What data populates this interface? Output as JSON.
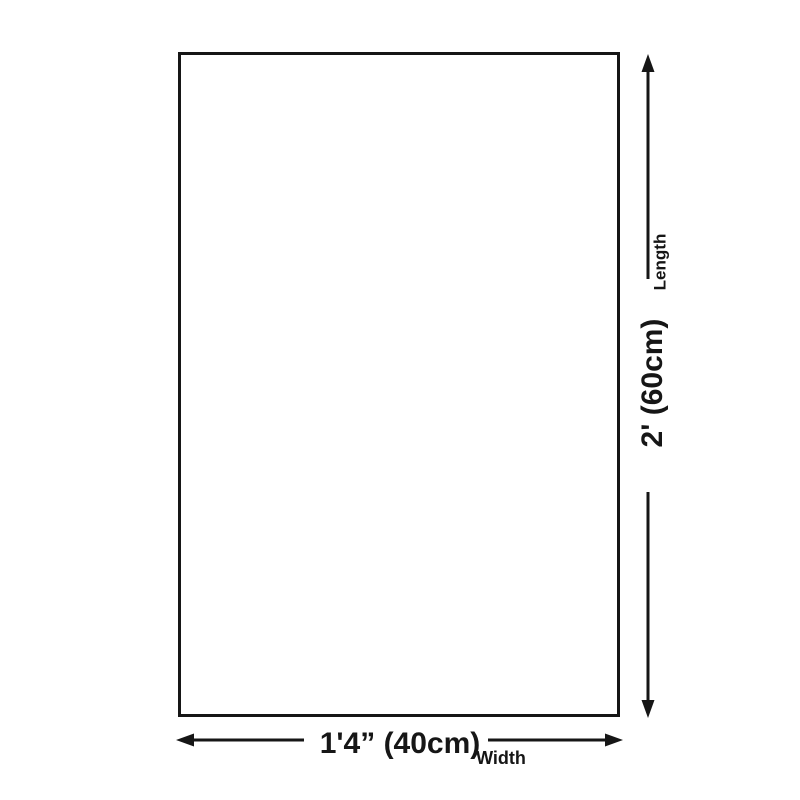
{
  "page": {
    "background_color": "#ffffff",
    "ink_color": "#161616",
    "description": "Product size diagram of a blank rectangular canvas with dimension arrows"
  },
  "diagram": {
    "shape": "rectangle",
    "width": {
      "value": "1'4” (40cm)",
      "label": "Width"
    },
    "length": {
      "value": "2' (60cm)",
      "label": "Length"
    }
  }
}
